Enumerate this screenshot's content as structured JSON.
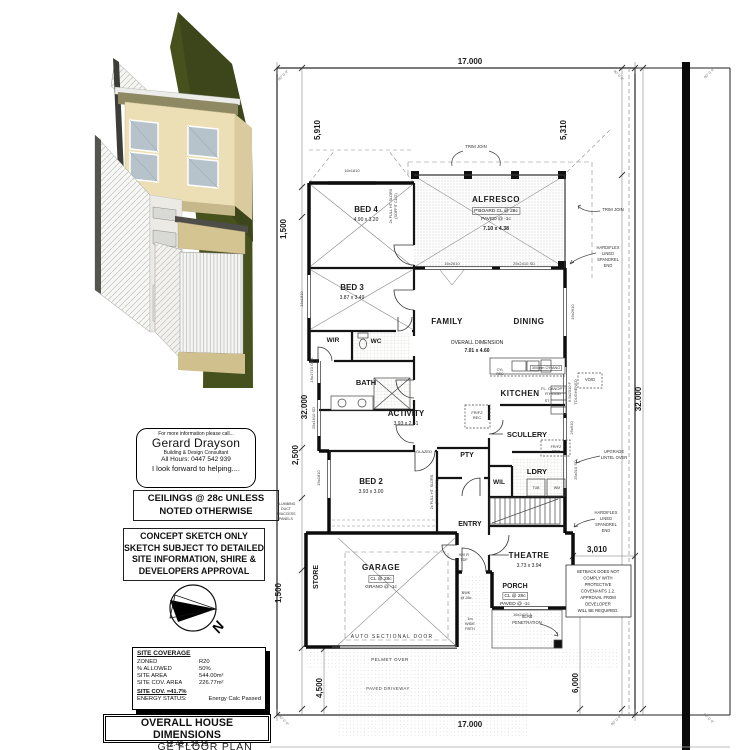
{
  "colors": {
    "paper": "#ffffff",
    "ink": "#111111",
    "hatch_gray": "#b5b5b0",
    "render_green": "#47511d",
    "render_wall_cream": "#ecdfb6",
    "render_tan": "#d3c492",
    "render_window_blue": "#b6c3ca",
    "render_roof_white": "#f4f4f1"
  },
  "contact": {
    "line1": "For more information please call...",
    "name": "Gerard Drayson",
    "role": "Building & Design Consultant",
    "hours": "All Hours:  0447 542 939",
    "closing": "I look forward to helping...."
  },
  "ceiling_note": {
    "line1": "CEILINGS @ 28c UNLESS",
    "line2": "NOTED OTHERWISE"
  },
  "concept_note": {
    "line1": "CONCEPT SKETCH ONLY",
    "line2": "SKETCH SUBJECT TO DETAILED",
    "line3": "SITE INFORMATION, SHIRE &",
    "line4": "DEVELOPERS APPROVAL"
  },
  "compass": {
    "label": "N"
  },
  "site_coverage": {
    "title": "SITE COVERAGE",
    "rows": [
      {
        "label": "ZONED",
        "value": "R20"
      },
      {
        "label": "% ALLOWED",
        "value": "50%"
      },
      {
        "label": "SITE AREA",
        "value": "544.00m²"
      },
      {
        "label": "SITE COV. AREA",
        "value": "226.77m²"
      }
    ],
    "coverage": "SITE COV. =41.7%",
    "energy_label": "ENERGY STATUS:",
    "energy_value": "Energy Calc Passed"
  },
  "overall_dimensions": {
    "title": "OVERALL HOUSE DIMENSIONS",
    "value": "12.49 x 22.19"
  },
  "plan_title_partial": "GE FLOOR PLAN",
  "plan": {
    "texts": [
      {
        "t": "17.000",
        "x": 470,
        "y": 64,
        "s": 8,
        "b": 1,
        "n": "dim-top-17000"
      },
      {
        "t": "17.000",
        "x": 470,
        "y": 727,
        "s": 8,
        "b": 1,
        "n": "dim-bottom-17000"
      },
      {
        "t": "5,910",
        "x": 320,
        "y": 130,
        "s": 8,
        "b": 1,
        "r": -90,
        "n": "dim-left-5910"
      },
      {
        "t": "5,310",
        "x": 566,
        "y": 130,
        "s": 8,
        "b": 1,
        "r": -90,
        "n": "dim-right-5310"
      },
      {
        "t": "1,500",
        "x": 286,
        "y": 229,
        "s": 8,
        "b": 1,
        "r": -90,
        "n": "dim-left-1500-upper"
      },
      {
        "t": "32.000",
        "x": 307,
        "y": 407,
        "s": 8,
        "b": 1,
        "r": -90,
        "n": "dim-left-32000"
      },
      {
        "t": "2,500",
        "x": 298,
        "y": 455,
        "s": 8,
        "b": 1,
        "r": -90,
        "n": "dim-left-2500"
      },
      {
        "t": "1,500",
        "x": 281,
        "y": 593,
        "s": 8,
        "b": 1,
        "r": -90,
        "n": "dim-left-1500-lower"
      },
      {
        "t": "4,500",
        "x": 322,
        "y": 688,
        "s": 8,
        "b": 1,
        "r": -90,
        "n": "dim-left-4500"
      },
      {
        "t": "32.000",
        "x": 641,
        "y": 399,
        "s": 8,
        "b": 1,
        "r": -90,
        "n": "dim-right-32000"
      },
      {
        "t": "6,000",
        "x": 578,
        "y": 683,
        "s": 8,
        "b": 1,
        "r": -90,
        "n": "dim-right-6000"
      },
      {
        "t": "3,010",
        "x": 597,
        "y": 552,
        "s": 8,
        "b": 1,
        "n": "dim-3010"
      },
      {
        "t": "90° 0' 0\"",
        "x": 284,
        "y": 76,
        "s": 3.5,
        "r": -45,
        "c": "#666",
        "n": "bearing-top-left"
      },
      {
        "t": "90° 0' 0\"",
        "x": 618,
        "y": 76,
        "s": 3.5,
        "r": 45,
        "c": "#666",
        "n": "bearing-top-inner-right"
      },
      {
        "t": "90° 0' 0\"",
        "x": 710,
        "y": 74,
        "s": 3.5,
        "r": -45,
        "c": "#666",
        "n": "bearing-top-right"
      },
      {
        "t": "90° 0' 0\"",
        "x": 283,
        "y": 721,
        "s": 3.5,
        "r": 45,
        "c": "#666",
        "n": "bearing-bottom-left"
      },
      {
        "t": "90° 0' 0\"",
        "x": 617,
        "y": 721,
        "s": 3.5,
        "r": -45,
        "c": "#666",
        "n": "bearing-bottom-inner-right"
      },
      {
        "t": "90° 0' 0\"",
        "x": 708,
        "y": 719,
        "s": 3.5,
        "r": 45,
        "c": "#666",
        "n": "bearing-bottom-right"
      },
      {
        "t": "BED 4",
        "x": 366,
        "y": 212,
        "s": 8,
        "b": 1,
        "n": "room-bed4"
      },
      {
        "t": "4.90 x 3.20",
        "x": 366,
        "y": 221,
        "s": 5,
        "n": "room-bed4-size"
      },
      {
        "t": "BED 3",
        "x": 352,
        "y": 290,
        "s": 8,
        "b": 1,
        "n": "room-bed3"
      },
      {
        "t": "3.87 x 3.49",
        "x": 352,
        "y": 299,
        "s": 5,
        "n": "room-bed3-size"
      },
      {
        "t": "ALFRESCO",
        "x": 496,
        "y": 202,
        "s": 8,
        "b": 1,
        "ls": 0.5,
        "n": "room-alfresco"
      },
      {
        "t": "P'BOARD CL @ 28c",
        "x": 496,
        "y": 212,
        "s": 4.8,
        "box": 1,
        "n": "alfresco-ceiling-note"
      },
      {
        "t": "PAVED @ -1c",
        "x": 496,
        "y": 220,
        "s": 4.8,
        "n": "alfresco-paved-note"
      },
      {
        "t": "7.10 x 4.38",
        "x": 496,
        "y": 230,
        "s": 5.2,
        "b": 1,
        "n": "room-alfresco-size"
      },
      {
        "t": "FAMILY",
        "x": 447,
        "y": 324,
        "s": 8,
        "b": 1,
        "ls": 0.5,
        "n": "room-family"
      },
      {
        "t": "DINING",
        "x": 529,
        "y": 324,
        "s": 8,
        "b": 1,
        "ls": 0.5,
        "n": "room-dining"
      },
      {
        "t": "OVERALL DIMENSION",
        "x": 477,
        "y": 344,
        "s": 5,
        "n": "family-overall-dim-label"
      },
      {
        "t": "7.01 x 4.60",
        "x": 477,
        "y": 352,
        "s": 5,
        "b": 1,
        "n": "family-overall-dim-value"
      },
      {
        "t": "KITCHEN",
        "x": 520,
        "y": 396,
        "s": 8,
        "b": 1,
        "ls": 0.5,
        "n": "room-kitchen"
      },
      {
        "t": "SCULLERY",
        "x": 527,
        "y": 437,
        "s": 7.5,
        "b": 1,
        "n": "room-scullery"
      },
      {
        "t": "ACTIVITY",
        "x": 406,
        "y": 416,
        "s": 8,
        "b": 1,
        "n": "room-activity"
      },
      {
        "t": "3.93 x 2.41",
        "x": 406,
        "y": 425,
        "s": 5,
        "n": "room-activity-size"
      },
      {
        "t": "BED 2",
        "x": 371,
        "y": 484,
        "s": 8,
        "b": 1,
        "n": "room-bed2"
      },
      {
        "t": "3.93 x 3.00",
        "x": 371,
        "y": 493,
        "s": 5,
        "n": "room-bed2-size"
      },
      {
        "t": "PTY",
        "x": 467,
        "y": 457,
        "s": 7,
        "b": 1,
        "n": "room-pantry"
      },
      {
        "t": "WIL",
        "x": 499,
        "y": 484,
        "s": 6.5,
        "b": 1,
        "n": "room-wil"
      },
      {
        "t": "LDRY",
        "x": 537,
        "y": 474,
        "s": 7.5,
        "b": 1,
        "n": "room-laundry"
      },
      {
        "t": "ENTRY",
        "x": 470,
        "y": 526,
        "s": 7,
        "b": 1,
        "n": "room-entry"
      },
      {
        "t": "THEATRE",
        "x": 529,
        "y": 558,
        "s": 8,
        "b": 1,
        "ls": 0.5,
        "n": "room-theatre"
      },
      {
        "t": "3.73 x 3.94",
        "x": 529,
        "y": 567,
        "s": 5,
        "n": "room-theatre-size"
      },
      {
        "t": "PORCH",
        "x": 515,
        "y": 588,
        "s": 7,
        "b": 1,
        "n": "room-porch"
      },
      {
        "t": "CL @ 28c",
        "x": 515,
        "y": 597,
        "s": 4.8,
        "box": 1,
        "n": "porch-ceiling-note"
      },
      {
        "t": "PAVED @ -1c",
        "x": 515,
        "y": 605,
        "s": 4.8,
        "n": "porch-paved-note"
      },
      {
        "t": "GARAGE",
        "x": 381,
        "y": 570,
        "s": 8,
        "b": 1,
        "ls": 0.5,
        "n": "room-garage"
      },
      {
        "t": "CL @ 28c",
        "x": 381,
        "y": 580,
        "s": 4.8,
        "box": 1,
        "n": "garage-ceiling-note"
      },
      {
        "t": "GRANO @ -1c",
        "x": 381,
        "y": 588,
        "s": 4.8,
        "n": "garage-floor-note"
      },
      {
        "t": "STORE",
        "x": 318,
        "y": 577,
        "s": 7,
        "b": 1,
        "r": -90,
        "n": "room-store"
      },
      {
        "t": "WIR",
        "x": 333,
        "y": 342,
        "s": 6.5,
        "b": 1,
        "n": "room-wir"
      },
      {
        "t": "WC",
        "x": 376,
        "y": 343,
        "s": 6.5,
        "b": 1,
        "n": "room-wc"
      },
      {
        "t": "BATH",
        "x": 366,
        "y": 385,
        "s": 7.5,
        "b": 1,
        "n": "room-bath"
      },
      {
        "t": "TRIM JOIN",
        "x": 476,
        "y": 148,
        "s": 4.3,
        "c": "#333",
        "n": "trim-join-top-note"
      },
      {
        "t": "TRIM JOIN",
        "x": 613,
        "y": 211,
        "s": 4.3,
        "c": "#333",
        "n": "trim-join-right-note"
      },
      {
        "t": "HARDIFLEX",
        "x": 608,
        "y": 249,
        "s": 4.1,
        "c": "#333",
        "n": "hardiflex-note1-l1"
      },
      {
        "t": "LINED",
        "x": 608,
        "y": 255,
        "s": 4.1,
        "c": "#333",
        "n": "hardiflex-note1-l2"
      },
      {
        "t": "SPANDREL",
        "x": 608,
        "y": 261,
        "s": 4.1,
        "c": "#333",
        "n": "hardiflex-note1-l3"
      },
      {
        "t": "END",
        "x": 608,
        "y": 267,
        "s": 4.1,
        "c": "#333",
        "n": "hardiflex-note1-l4"
      },
      {
        "t": "HARDIFLEX",
        "x": 606,
        "y": 514,
        "s": 4.1,
        "c": "#333",
        "n": "hardiflex-note2-l1"
      },
      {
        "t": "LINED",
        "x": 606,
        "y": 520,
        "s": 4.1,
        "c": "#333",
        "n": "hardiflex-note2-l2"
      },
      {
        "t": "SPANDREL",
        "x": 606,
        "y": 526,
        "s": 4.1,
        "c": "#333",
        "n": "hardiflex-note2-l3"
      },
      {
        "t": "END",
        "x": 606,
        "y": 532,
        "s": 4.1,
        "c": "#333",
        "n": "hardiflex-note2-l4"
      },
      {
        "t": "UPGRADE",
        "x": 614,
        "y": 453,
        "s": 4.1,
        "c": "#333",
        "n": "upgrade-lintel-l1"
      },
      {
        "t": "LINTEL OVER",
        "x": 614,
        "y": 459,
        "s": 4.1,
        "c": "#333",
        "n": "upgrade-lintel-l2"
      },
      {
        "t": "SETBACK DOES NOT",
        "x": 598,
        "y": 573,
        "s": 4.2,
        "c": "#222",
        "n": "setback-note-l1"
      },
      {
        "t": "COMPLY WITH",
        "x": 598,
        "y": 579.5,
        "s": 4.2,
        "c": "#222",
        "n": "setback-note-l2"
      },
      {
        "t": "PROTECTIVE",
        "x": 598,
        "y": 586,
        "s": 4.2,
        "c": "#222",
        "n": "setback-note-l3"
      },
      {
        "t": "COVENANTS 1.2.",
        "x": 598,
        "y": 592.5,
        "s": 4.2,
        "c": "#222",
        "n": "setback-note-l4"
      },
      {
        "t": "APPROVAL FROM",
        "x": 598,
        "y": 599,
        "s": 4.2,
        "c": "#222",
        "n": "setback-note-l5"
      },
      {
        "t": "DEVELOPER",
        "x": 598,
        "y": 605.5,
        "s": 4.2,
        "c": "#222",
        "n": "setback-note-l6"
      },
      {
        "t": "WILL BE REQUIRED.",
        "x": 598,
        "y": 612,
        "s": 4.2,
        "c": "#222",
        "n": "setback-note-l7"
      },
      {
        "t": "SLAB",
        "x": 527,
        "y": 618,
        "s": 4.2,
        "c": "#333",
        "n": "slab-penetration-l1"
      },
      {
        "t": "PENETRATION",
        "x": 527,
        "y": 624,
        "s": 4.2,
        "c": "#333",
        "n": "slab-penetration-l2"
      },
      {
        "t": "AUTO SECTIONAL DOOR",
        "x": 392,
        "y": 638,
        "s": 5,
        "ls": 1.2,
        "c": "#333",
        "n": "auto-sectional-door-label"
      },
      {
        "t": "PELMET OVER",
        "x": 390,
        "y": 661,
        "s": 4.5,
        "ls": 0.5,
        "c": "#333",
        "n": "pelmet-over-label"
      },
      {
        "t": "PAVED DRIVEWAY",
        "x": 388,
        "y": 690,
        "s": 4.2,
        "ls": 0.5,
        "c": "#444",
        "n": "paved-driveway-label"
      },
      {
        "t": "300mm O'HANG",
        "x": 546,
        "y": 369,
        "s": 3.8,
        "box": 1,
        "c": "#333",
        "n": "overhang-label"
      },
      {
        "t": "FL. CANOPY",
        "x": 553,
        "y": 390,
        "s": 4,
        "c": "#333",
        "n": "canopy-label-l1"
      },
      {
        "t": "R'HOOD",
        "x": 553,
        "y": 395,
        "s": 4,
        "c": "#333",
        "n": "canopy-label-l2"
      },
      {
        "t": "VOID",
        "x": 590,
        "y": 381,
        "s": 4.2,
        "c": "#333",
        "n": "void-label"
      },
      {
        "t": "CYL",
        "x": 500,
        "y": 371,
        "s": 3.5,
        "c": "#333",
        "n": "cyl-rec-l1"
      },
      {
        "t": "REC",
        "x": 500,
        "y": 375,
        "s": 3.5,
        "c": "#333",
        "n": "cyl-rec-l2"
      },
      {
        "t": "FR/FZ",
        "x": 477,
        "y": 414,
        "s": 4,
        "c": "#333",
        "n": "fridge-recess-l1"
      },
      {
        "t": "REC",
        "x": 477,
        "y": 419,
        "s": 4,
        "c": "#333",
        "n": "fridge-recess-l2"
      },
      {
        "t": "FR/FZ",
        "x": 556,
        "y": 448,
        "s": 3.8,
        "c": "#333",
        "n": "fridge-recess2-l1"
      },
      {
        "t": "REC",
        "x": 556,
        "y": 452.5,
        "s": 3.8,
        "c": "#333",
        "n": "fridge-recess2-l2"
      },
      {
        "t": "TUB",
        "x": 536,
        "y": 489,
        "s": 3.5,
        "c": "#333",
        "n": "laundry-tub-label"
      },
      {
        "t": "WM",
        "x": 557,
        "y": 489,
        "s": 3.5,
        "c": "#333",
        "n": "washing-machine-label"
      },
      {
        "t": "ST",
        "x": 547,
        "y": 402,
        "s": 3.8,
        "c": "#333",
        "n": "stove-label"
      },
      {
        "t": "GLAZED",
        "x": 424,
        "y": 453,
        "s": 4,
        "c": "#333",
        "n": "glazed-label"
      },
      {
        "t": "920 R",
        "x": 464,
        "y": 556,
        "s": 3.8,
        "c": "#333",
        "n": "door-920-l1"
      },
      {
        "t": "TDF",
        "x": 464,
        "y": 561,
        "s": 3.8,
        "c": "#333",
        "n": "door-920-l2"
      },
      {
        "t": "BWK",
        "x": 466,
        "y": 594,
        "s": 3.8,
        "c": "#333",
        "n": "bwk-label-l1"
      },
      {
        "t": "@ 28c",
        "x": 466,
        "y": 599,
        "s": 3.8,
        "c": "#333",
        "n": "bwk-label-l2"
      },
      {
        "t": "1m",
        "x": 470,
        "y": 620,
        "s": 3.8,
        "c": "#333",
        "n": "path-label-l1"
      },
      {
        "t": "WIDE",
        "x": 470,
        "y": 625,
        "s": 3.8,
        "c": "#333",
        "n": "path-label-l2"
      },
      {
        "t": "PATH",
        "x": 470,
        "y": 630,
        "s": 3.8,
        "c": "#333",
        "n": "path-label-l3"
      },
      {
        "t": "2x FULL HT. SLDRS",
        "x": 392,
        "y": 206,
        "r": -90,
        "s": 3.8,
        "c": "#333",
        "n": "sliders-note1-l1"
      },
      {
        "t": "(SOFFIT CL'G)",
        "x": 397,
        "y": 206,
        "r": -90,
        "s": 3.8,
        "c": "#333",
        "n": "sliders-note1-l2"
      },
      {
        "t": "2x FULL HT. SLDRS",
        "x": 433,
        "y": 492,
        "r": -90,
        "s": 3.8,
        "c": "#333",
        "n": "sliders-note2-l1"
      },
      {
        "t": "(SOFFIT CL'G)",
        "x": 438,
        "y": 492,
        "r": -90,
        "s": 3.8,
        "c": "#333",
        "n": "sliders-note2-l2"
      },
      {
        "t": "PLUMBING",
        "x": 286,
        "y": 505,
        "s": 3.6,
        "c": "#333",
        "n": "plumbing-duct-l1"
      },
      {
        "t": "DUCT",
        "x": 286,
        "y": 510,
        "s": 3.6,
        "c": "#333",
        "n": "plumbing-duct-l2"
      },
      {
        "t": "W/ACCESS",
        "x": 286,
        "y": 515,
        "s": 3.6,
        "c": "#333",
        "n": "plumbing-duct-l3"
      },
      {
        "t": "PANELS",
        "x": 286,
        "y": 520,
        "s": 3.6,
        "c": "#333",
        "n": "plumbing-duct-l4"
      },
      {
        "t": "16x1810",
        "x": 352,
        "y": 172,
        "s": 4,
        "c": "#444",
        "n": "window-bed4"
      },
      {
        "t": "16x1810",
        "x": 303,
        "y": 299,
        "r": -90,
        "s": 4,
        "c": "#444",
        "n": "window-bed3"
      },
      {
        "t": "16x1810",
        "x": 320,
        "y": 478,
        "r": -90,
        "s": 4,
        "c": "#444",
        "n": "window-bed2"
      },
      {
        "t": "16x1710 OBS",
        "x": 313,
        "y": 370,
        "r": -90,
        "s": 4,
        "c": "#444",
        "n": "window-bath-obs"
      },
      {
        "t": "25x1610 SD",
        "x": 315,
        "y": 418,
        "r": -90,
        "s": 4,
        "c": "#444",
        "n": "window-activity-sd"
      },
      {
        "t": "16x2610",
        "x": 452,
        "y": 265,
        "s": 4,
        "c": "#444",
        "n": "window-alfresco-left"
      },
      {
        "t": "25x2410 SD",
        "x": 524,
        "y": 265,
        "s": 4,
        "c": "#444",
        "n": "window-alfresco-sd"
      },
      {
        "t": "16x2610",
        "x": 574,
        "y": 312,
        "r": -90,
        "s": 4,
        "c": "#444",
        "n": "window-dining"
      },
      {
        "t": "6.5x2310 F",
        "x": 571,
        "y": 392,
        "r": -90,
        "s": 4,
        "c": "#444",
        "n": "window-kitchen-f"
      },
      {
        "t": "TOUGHENED",
        "x": 577,
        "y": 392,
        "r": -90,
        "s": 4,
        "c": "#444",
        "n": "window-kitchen-toughened"
      },
      {
        "t": "25x910",
        "x": 573,
        "y": 428,
        "r": -90,
        "s": 4,
        "c": "#444",
        "n": "window-scullery"
      },
      {
        "t": "25x910 SD",
        "x": 577,
        "y": 470,
        "r": -90,
        "s": 4,
        "c": "#444",
        "n": "window-laundry-sd"
      },
      {
        "t": "16x2410 A.",
        "x": 523,
        "y": 616,
        "s": 4,
        "c": "#444",
        "n": "window-theatre"
      }
    ]
  }
}
